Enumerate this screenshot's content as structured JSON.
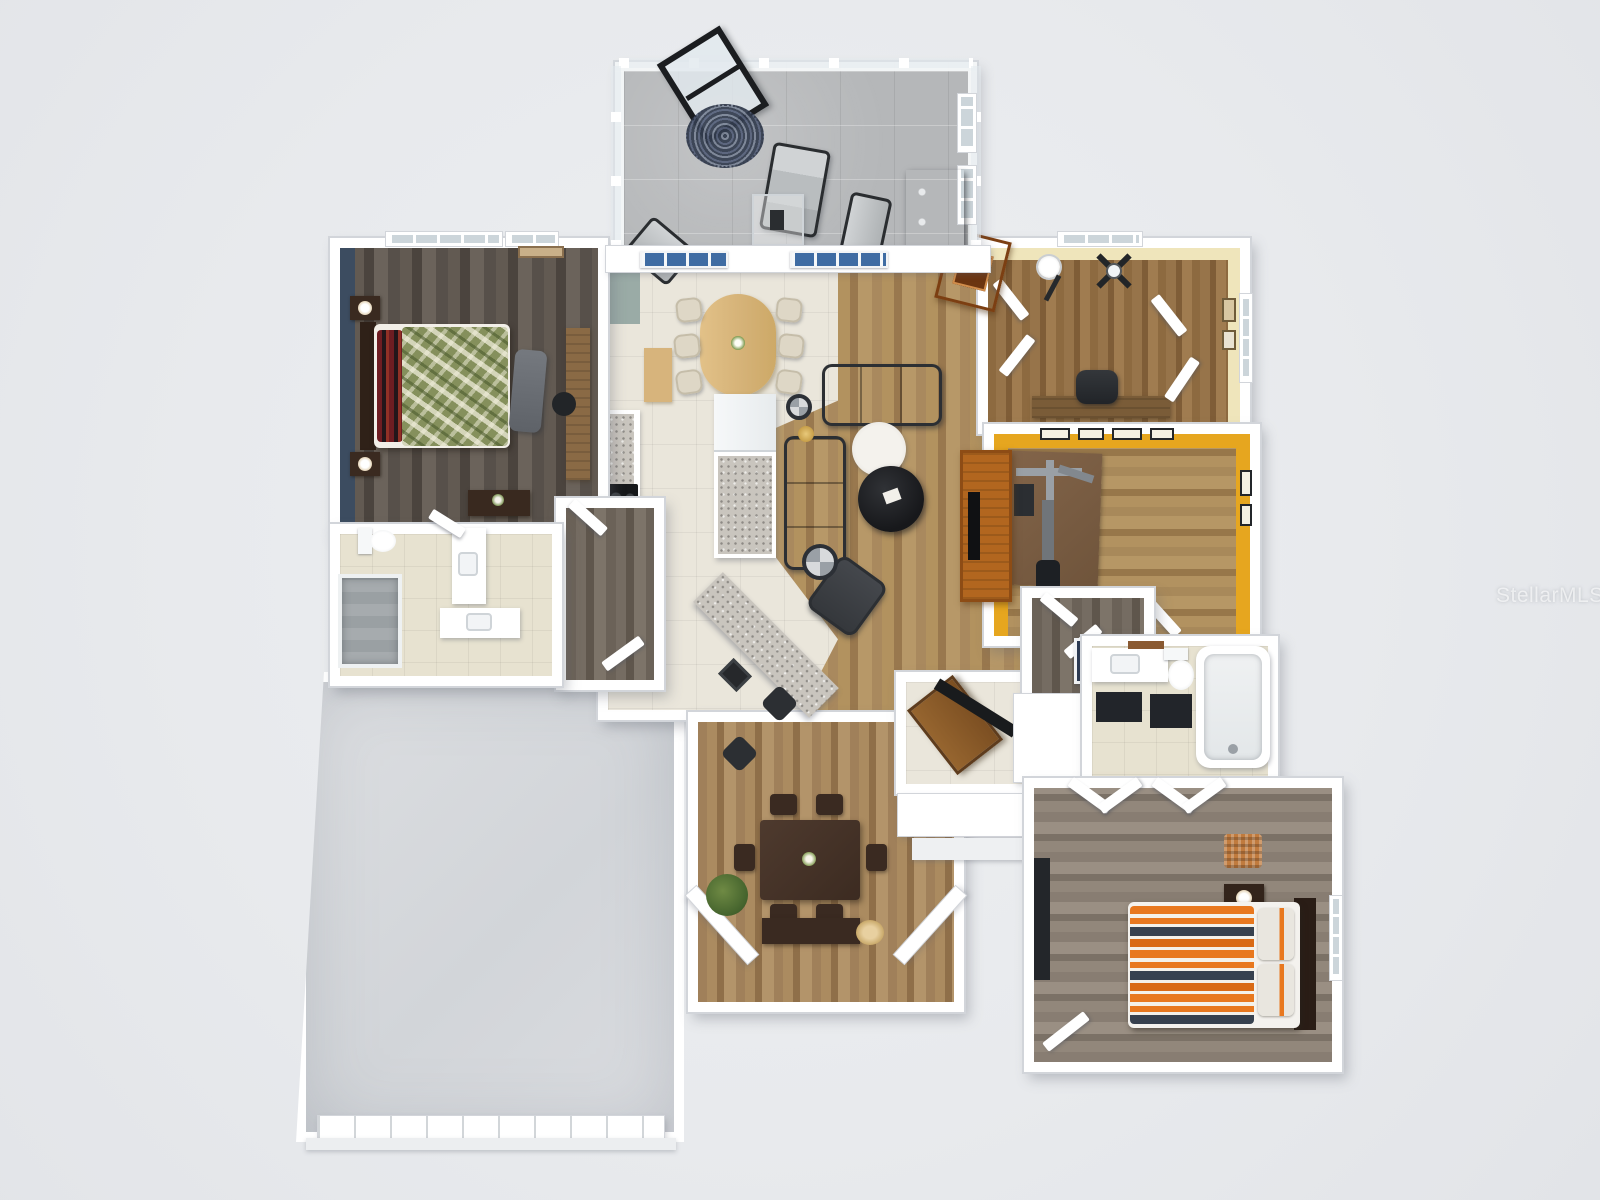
{
  "watermark": {
    "text": "StellarMLS"
  },
  "colors": {
    "background": "#e8eaed",
    "wall": "#ffffff",
    "wallEdge": "#d2d5da",
    "navyAccent": "#3c4c60",
    "goldWall": "#e6a61f",
    "officeWall": "#efe5bb",
    "lanaiFloor": "#b5b7b9",
    "tileCream": "#eae6db",
    "tileBath": "#e7e2d0",
    "granite": "#c9c5be",
    "doorBlue": "#3f6ca3",
    "sofaDark": "#3b3e42",
    "bedGreen": "#85905c",
    "bedOrange": "#e8781f",
    "bedNavyStripe": "#37414f",
    "tableDark": "#46342a",
    "woodWarm": "#b2661f",
    "nookTable": "#dcba80",
    "chairCream": "#ded7c6",
    "black": "#17181a"
  },
  "plan": {
    "style": "3D dollhouse top-down render",
    "rooms": [
      {
        "name": "lanai-sunroom",
        "floor": "gray tile, glass walls"
      },
      {
        "name": "master-bedroom",
        "floor": "dark gray wood",
        "accent": "navy wall"
      },
      {
        "name": "master-bathroom",
        "floor": "beige tile"
      },
      {
        "name": "hallway-closet",
        "floor": "dark wood"
      },
      {
        "name": "kitchen-breakfast-nook",
        "floor": "cream tile"
      },
      {
        "name": "living-room",
        "floor": "medium oak wood"
      },
      {
        "name": "office-den",
        "floor": "oak wood",
        "accent": "pale yellow walls"
      },
      {
        "name": "home-gym",
        "floor": "oak wood",
        "accent": "gold walls"
      },
      {
        "name": "hallway-right",
        "floor": "wood"
      },
      {
        "name": "bathroom-2",
        "floor": "beige tile"
      },
      {
        "name": "guest-bedroom",
        "floor": "gray wood"
      },
      {
        "name": "dining-room",
        "floor": "oak wood, bay window"
      },
      {
        "name": "foyer-entry",
        "floor": "cream tile"
      },
      {
        "name": "porch",
        "floor": "white steps"
      },
      {
        "name": "garage",
        "floor": "bare concrete"
      }
    ],
    "furniture": [
      "lounge-chairs",
      "glass-side-table",
      "round-mandala-rug",
      "black-console",
      "master-bed-green",
      "nightstands",
      "bench",
      "desk",
      "dresser",
      "toilet",
      "walk-in-shower",
      "vanities",
      "bathtub",
      "oval-nook-table",
      "cream-chairs",
      "range",
      "island-fridge",
      "granite-peninsula",
      "bar-stools",
      "sectional-sofas",
      "recliner",
      "round-coffee-tables",
      "media-console",
      "dining-table",
      "dining-chairs",
      "plant",
      "sideboard",
      "office-desk",
      "office-chair",
      "floor-lamp",
      "ceiling-fan",
      "armoire",
      "gym-machine",
      "exercise-mat",
      "guest-bed-orange-stripes",
      "hamper",
      "tv-dresser",
      "front-door"
    ]
  }
}
